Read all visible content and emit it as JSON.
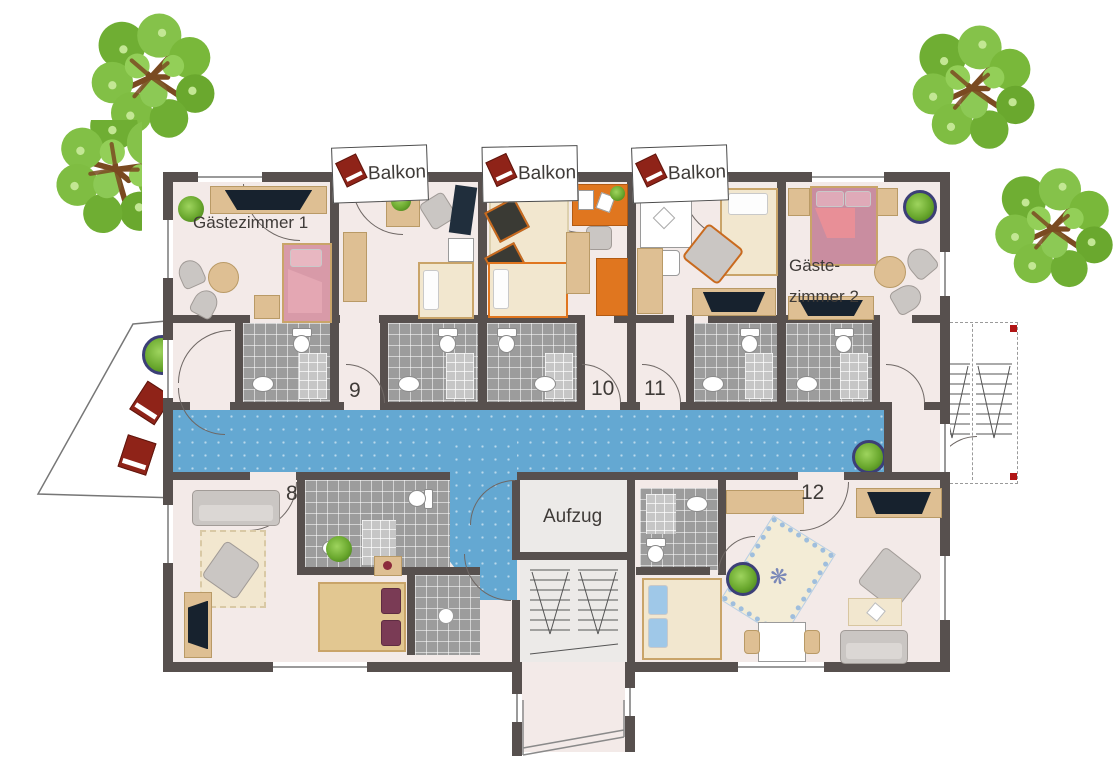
{
  "title": "hotel floor plan",
  "labels": {
    "guest_room_1": "Gästezimmer 1",
    "guest_room_2_line1": "Gäste-",
    "guest_room_2_line2": "zimmer 2",
    "elevator": "Aufzug",
    "balcony_1": "Balkon",
    "balcony_2": "Balkon",
    "balcony_3": "Balkon",
    "room_8": "8",
    "room_9": "9",
    "room_10": "10",
    "room_11": "11",
    "room_12": "12"
  },
  "icons": {
    "rug_medallion": "❋",
    "names": [
      "tree-icon",
      "balcony-chair-icon",
      "plant-icon",
      "toilet-icon",
      "sink-icon",
      "stairs-icon",
      "tv-icon",
      "bed-icon",
      "sofa-icon",
      "rug-icon"
    ]
  },
  "colors": {
    "wall": "#57504e",
    "floor": "#f3eae8",
    "corridor": "#64a8d2",
    "tile": "#9c9c9c",
    "tile-light": "#c6c6c6",
    "accent-red": "#8f2318",
    "wood": "#debf93",
    "text": "#3f3b38",
    "pink-bed": "#cf93a4",
    "orange": "#e0761f",
    "tree-green": "#79b83a"
  }
}
